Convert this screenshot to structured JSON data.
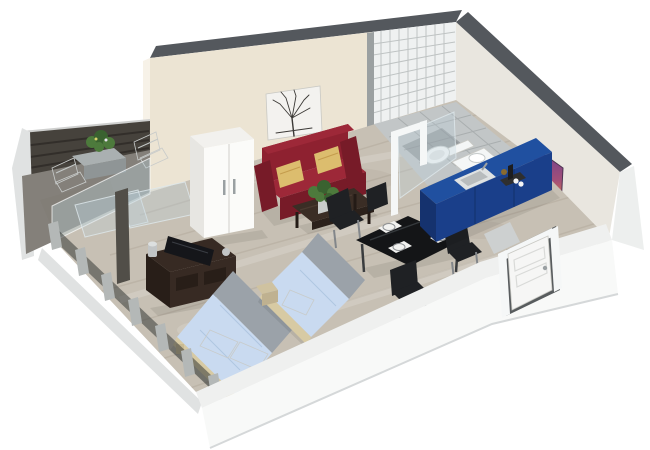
{
  "scene": {
    "label": "3D isometric rendering of a studio apartment floor plan with balcony, sleeping area, living area, dining set, kitchenette, bathroom and entrance door",
    "background": "#ffffff"
  },
  "rooms": [
    "balcony",
    "sleeping-area",
    "living-area",
    "dining-area",
    "kitchenette",
    "bathroom",
    "entrance"
  ],
  "furniture": [
    "balcony-table",
    "balcony-chairs",
    "planter",
    "wardrobe",
    "tree-artwork",
    "red-sofa",
    "gold-pillows",
    "coffee-table",
    "potted-plant",
    "tv-dresser",
    "flat-tv",
    "double-bed",
    "single-bed",
    "nightstand",
    "dining-table",
    "dining-chairs",
    "place-settings",
    "kitchen-counter",
    "sink",
    "toilet",
    "shower-frame",
    "purple-artwork",
    "entrance-door",
    "window-mullions",
    "glass-partition"
  ],
  "colors": {
    "wall_cap": "#54585d",
    "wall_beige": "#ece4d3",
    "wall_beige_end": "#f7f2e8",
    "wall_white": "#e9e6df",
    "tile_wall": "#eff1f1",
    "tile_edge": "#9ba0a1",
    "right_outer": "#edefee",
    "front_top": "#eff0ef",
    "front_outer": "#f8f9f8",
    "floor_main": "#c7c0b4",
    "floor_bathroom": "#c2c6c7",
    "floor_balcony": "#84807a",
    "curb": "#9aa0a0",
    "railing": "#46423c",
    "glass": "#bcd2da",
    "frame_white": "#f5f7f7",
    "window_post": "#b4b8b7",
    "window_glass": "#343936",
    "outer_band": "#e0e2e2",
    "wardrobe": "#fbfbf9",
    "wardrobe_side": "#e7e6e2",
    "wardrobe_top": "#f2f1ee",
    "art_canvas": "#f3f2ef",
    "art_tree": "#3b3936",
    "art_purple": "#6b3f8f",
    "art_mid": "#a24f79",
    "art_orange": "#e2883f",
    "sofa": "#8e2130",
    "sofa_dark": "#771b28",
    "sofa_light": "#9d2838",
    "pillow_gold": "#dcbd6e",
    "coffee_table": "#3a2d25",
    "coffee_table_dark": "#2b211b",
    "plant_green": "#4d7a3c",
    "plant_dark": "#3a6230",
    "pot": "#c9cccb",
    "tv_stand": "#372a23",
    "tv_stand_dark": "#281e18",
    "tv_black": "#15161a",
    "metal": "#c2c5c6",
    "bed_linen": "#c9daf0",
    "bed_pillow": "#eef2f8",
    "bed_frame_tan": "#d7caa3",
    "headboard_gray": "#9ba2a9",
    "nightstand": "#cfc2a0",
    "dining_black": "#141517",
    "chair_black": "#1f2124",
    "plate_white": "#fdfdfd",
    "placemat": "#f2f2f0",
    "kitchen_blue": "#2050a0",
    "kitchen_blue_dark": "#1a3f8a",
    "kitchen_blue_side": "#15326e",
    "sink": "#dfe2e2",
    "sink_inner": "#b8bcbd",
    "toilet_white": "#f4f6f6",
    "door_white": "#f6f6f5",
    "door_recess": "#585c5e",
    "step": "#cdd0d0",
    "stone_table": "#aab0b1",
    "stone_dark": "#8f9596",
    "white_chair": "#eef0ef",
    "dark_post": "#514e48"
  }
}
